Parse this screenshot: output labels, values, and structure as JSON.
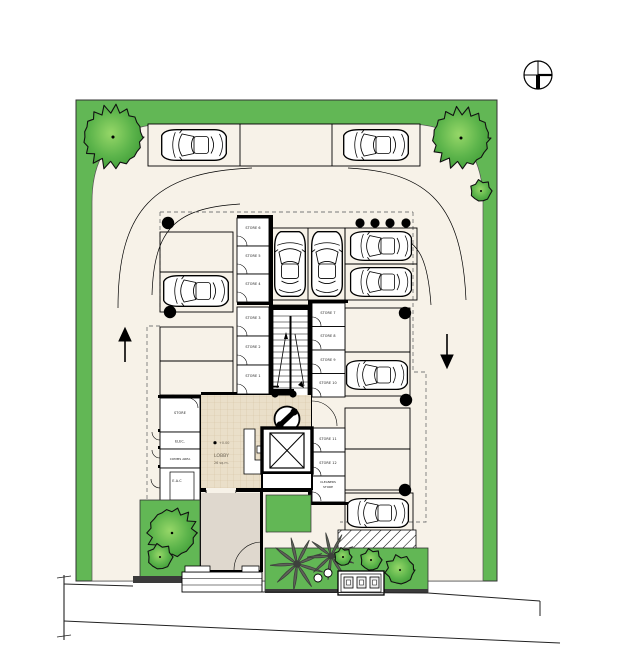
{
  "plan": {
    "stores": {
      "store_6": "STORE 6",
      "store_5": "STORE 5",
      "store_4": "STORE 4",
      "store_3": "STORE 3",
      "store_2": "STORE 2",
      "store_1": "STORE 1",
      "store_7": "STORE 7",
      "store_8": "STORE 8",
      "store_9": "STORE 9",
      "store_10": "STORE 10",
      "store_11": "STORE 11",
      "store_12": "STORE 12",
      "cleaners_line1": "CLEANERS",
      "cleaners_line2": "STORE"
    },
    "utility_rooms": {
      "store": "STORE",
      "elec": "ELEC.",
      "comms": "COMMS AREA",
      "eac": "E.A.C"
    },
    "lobby": {
      "level": "+0.00",
      "name": "LOBBY",
      "area": "26 sq.m."
    }
  },
  "icons": {
    "north_arrow": "north-arrow-icon",
    "tree": "tree-icon",
    "bush": "bush-icon",
    "palm_tree": "palm-tree-icon",
    "car": "car-top-view-icon",
    "motorcycle": "motorcycle-icon",
    "motorcycle_bay": "motorcycle-parking-circle-icon",
    "elevator": "elevator-icon",
    "stairs": "stairs-icon",
    "up_arrow": "traffic-up-arrow-icon",
    "down_arrow": "traffic-down-arrow-icon",
    "column": "structural-column-icon",
    "meters": "utility-meter-box-icon"
  },
  "colors": {
    "grass": "#62B755",
    "tree_dark": "#3F9C37",
    "paving": "#F7F2E8",
    "tile": "#EADFC9",
    "vestibule": "#DFD8CE",
    "palm": "#5F6359",
    "wall": "#000000",
    "kerb": "#3A3A3A"
  }
}
